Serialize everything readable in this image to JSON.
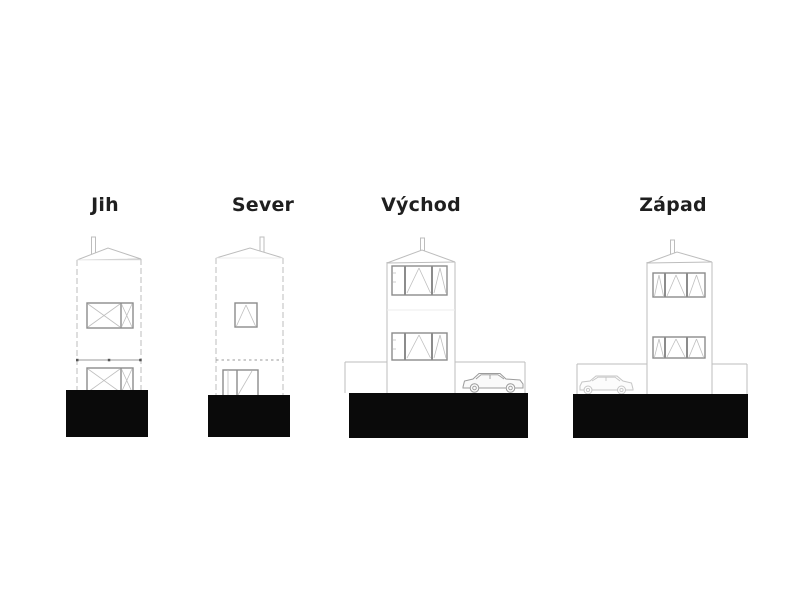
{
  "canvas": {
    "background": "#ffffff"
  },
  "colors": {
    "bg": "#ffffff",
    "label": "#1f1f1f",
    "line": "#bdbdbd",
    "frame": "#8c8c8c",
    "detail": "#9a9a9a",
    "ground": "#0a0a0a",
    "car": "#9c9c9c",
    "car_faint": "#c6c6c6"
  },
  "elevations": [
    {
      "id": "south",
      "label": "Jih",
      "features": [
        "chimney",
        "gable-roof",
        "upper-window",
        "floor-line",
        "lower-window",
        "ground-mass"
      ]
    },
    {
      "id": "north",
      "label": "Sever",
      "features": [
        "chimney",
        "gable-roof",
        "square-window",
        "dashed-floor-line",
        "entry-door",
        "ground-mass"
      ]
    },
    {
      "id": "east",
      "label": "Východ",
      "features": [
        "chimney",
        "gable-roof",
        "upper-window-band",
        "lower-window-band",
        "garden-fence",
        "carport",
        "parked-car",
        "ground-mass"
      ]
    },
    {
      "id": "west",
      "label": "Západ",
      "features": [
        "carport",
        "parked-car",
        "chimney",
        "gable-roof",
        "upper-window-band",
        "lower-window-band",
        "garden-fence",
        "ground-mass"
      ]
    }
  ]
}
